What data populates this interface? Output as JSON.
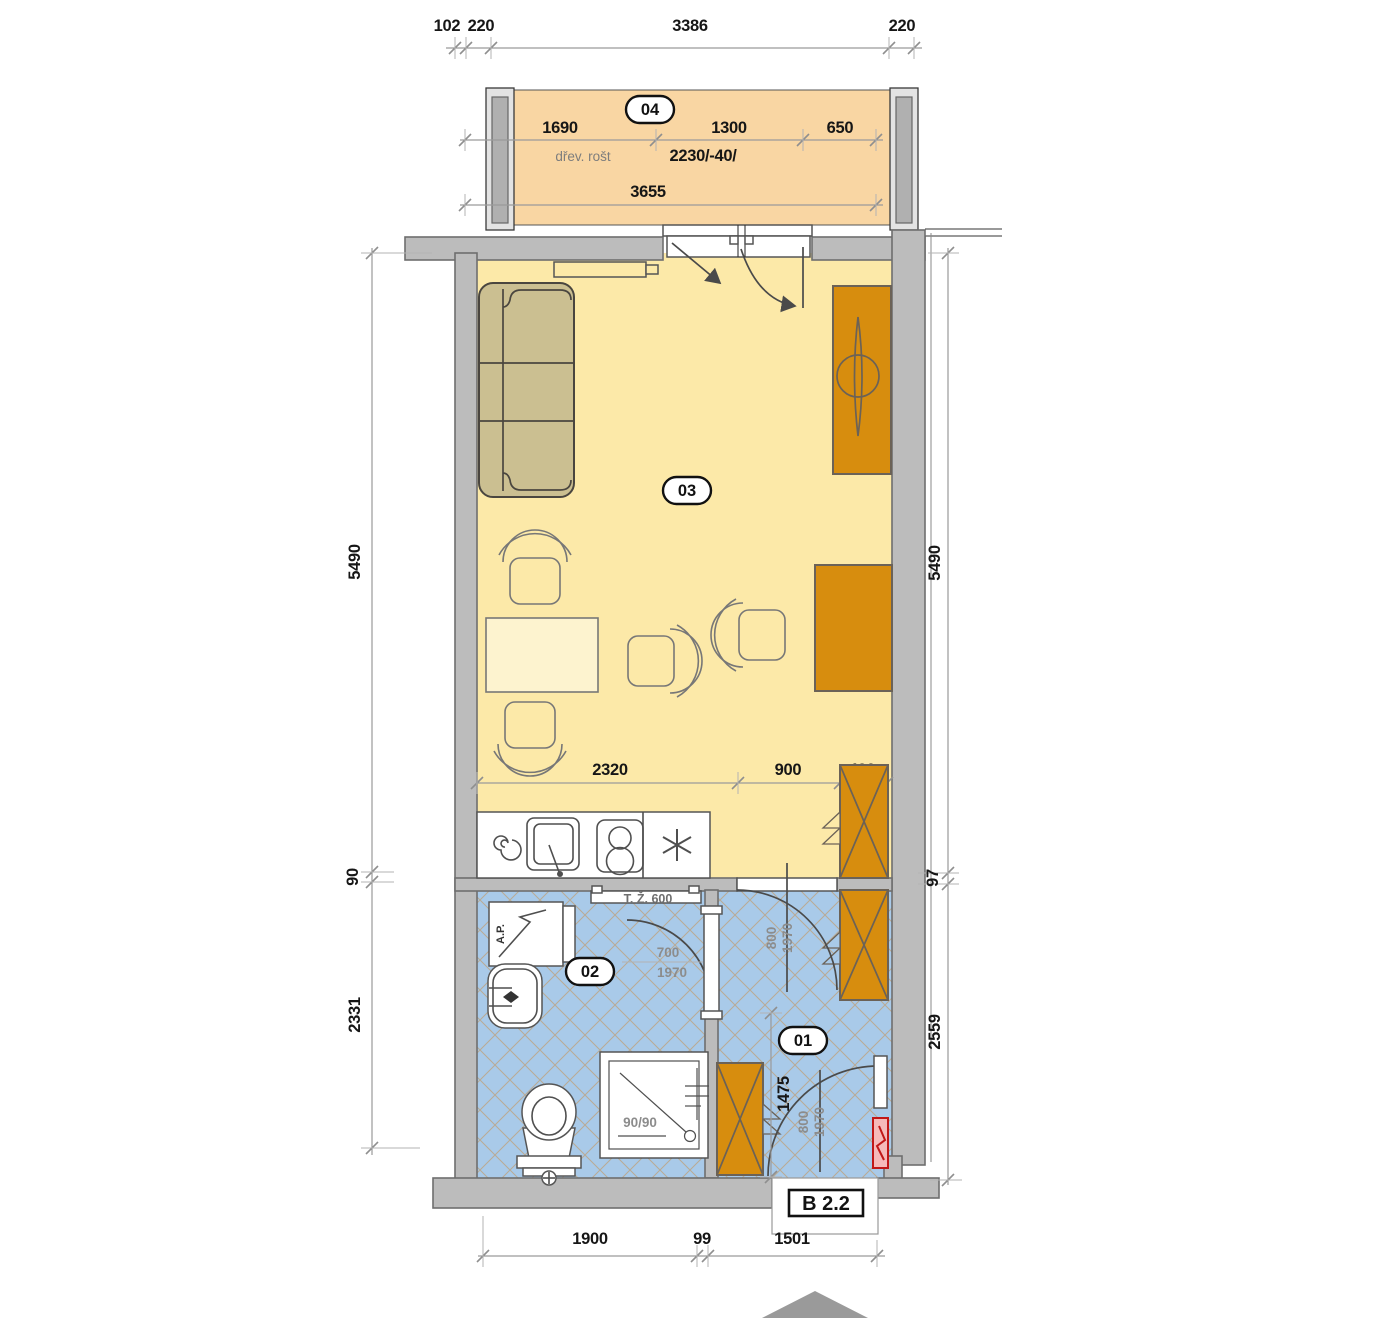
{
  "plan": {
    "unit_label": "B 2.2",
    "rooms": {
      "hall_number": "01",
      "bath_number": "02",
      "living_number": "03",
      "balcony_number": "04"
    },
    "annotations": {
      "balcony_note": "dřev. rošt",
      "balcony_opening": "2230/-40/",
      "towel_rail": "T. Ž. 600",
      "washing_machine": "A.P.",
      "shower_size": "90/90"
    },
    "dims": {
      "top": [
        "102",
        "220",
        "3386",
        "220"
      ],
      "balcony_row": [
        "1690",
        "1300",
        "650"
      ],
      "balcony_total": "3655",
      "left": [
        "5490",
        "90",
        "2331"
      ],
      "right": [
        "5490",
        "97",
        "2559"
      ],
      "living_bottom": [
        "2320",
        "900",
        "420"
      ],
      "hall_height": "1475",
      "bottom": [
        "1900",
        "99",
        "1501"
      ]
    },
    "doors": {
      "bath": {
        "w": "700",
        "h": "1970"
      },
      "hall": {
        "w": "800",
        "h": "1970"
      },
      "entry": {
        "w": "800",
        "h": "1970"
      }
    },
    "colors": {
      "wall": "#bcbcbc",
      "living_floor": "#fce9a8",
      "balcony_floor": "#f9d6a3",
      "wet_floor": "#a9cae9",
      "furniture": "#d78d0e",
      "sofa": "#cbbf91",
      "hatch": "#b8ab96",
      "alert": "#cc2222"
    },
    "symbols": [
      "sofa",
      "shelf",
      "wardrobe-mirror",
      "desk",
      "chair",
      "dining-table",
      "kitchen-sink",
      "cooktop",
      "fridge",
      "towel-rail",
      "washing-machine",
      "washbasin",
      "toilet",
      "shower",
      "wardrobe",
      "electrical-panel",
      "entry-arrow",
      "balcony-door-swing"
    ]
  }
}
